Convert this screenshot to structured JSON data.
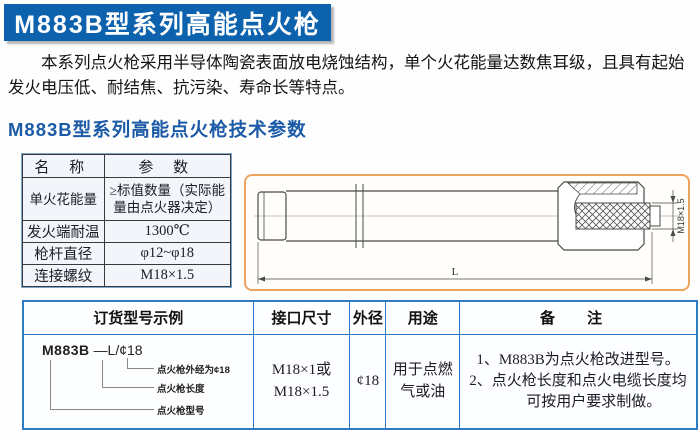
{
  "page": {
    "title": "M883B型系列高能点火枪",
    "intro": "本系列点火枪采用半导体陶瓷表面放电烧蚀结构，单个火花能量达数焦耳级，且具有起始发火电压低、耐结焦、抗污染、寿命长等特点。",
    "section_heading": "M883B型系列高能点火枪技术参数"
  },
  "spec_table": {
    "headers": [
      "名  称",
      "参  数"
    ],
    "rows": [
      {
        "name": "单火花能量",
        "value": "≥标值数量（实际能量由点火器决定）"
      },
      {
        "name": "发火端耐温",
        "value": "1300℃"
      },
      {
        "name": "枪杆直径",
        "value": "φ12~φ18"
      },
      {
        "name": "连接螺纹",
        "value": "M18×1.5"
      }
    ]
  },
  "drawing": {
    "length_label": "L",
    "thread_label": "M18×1.5"
  },
  "order_table": {
    "headers": [
      "订货型号示例",
      "接口尺寸",
      "外径",
      "用途",
      "备  注"
    ],
    "model_example": {
      "model": "M883B",
      "suffix": " —L/¢18",
      "callouts": [
        "点火枪外经为¢18",
        "点火枪长度",
        "点火枪型号"
      ]
    },
    "interface_size": [
      "M18×1或",
      "M18×1.5"
    ],
    "outer_diameter": "¢18",
    "usage": "用于点燃气或油",
    "remarks": [
      "1、M883B为点火枪改进型号。",
      "2、点火枪长度和点火电缆长度均可按用户要求制做。"
    ]
  },
  "colors": {
    "title_bar": "#0d62ae",
    "heading_text": "#1b5aa6",
    "table_border_blue": "#2e7bc4",
    "drawing_border": "#eea45f"
  }
}
